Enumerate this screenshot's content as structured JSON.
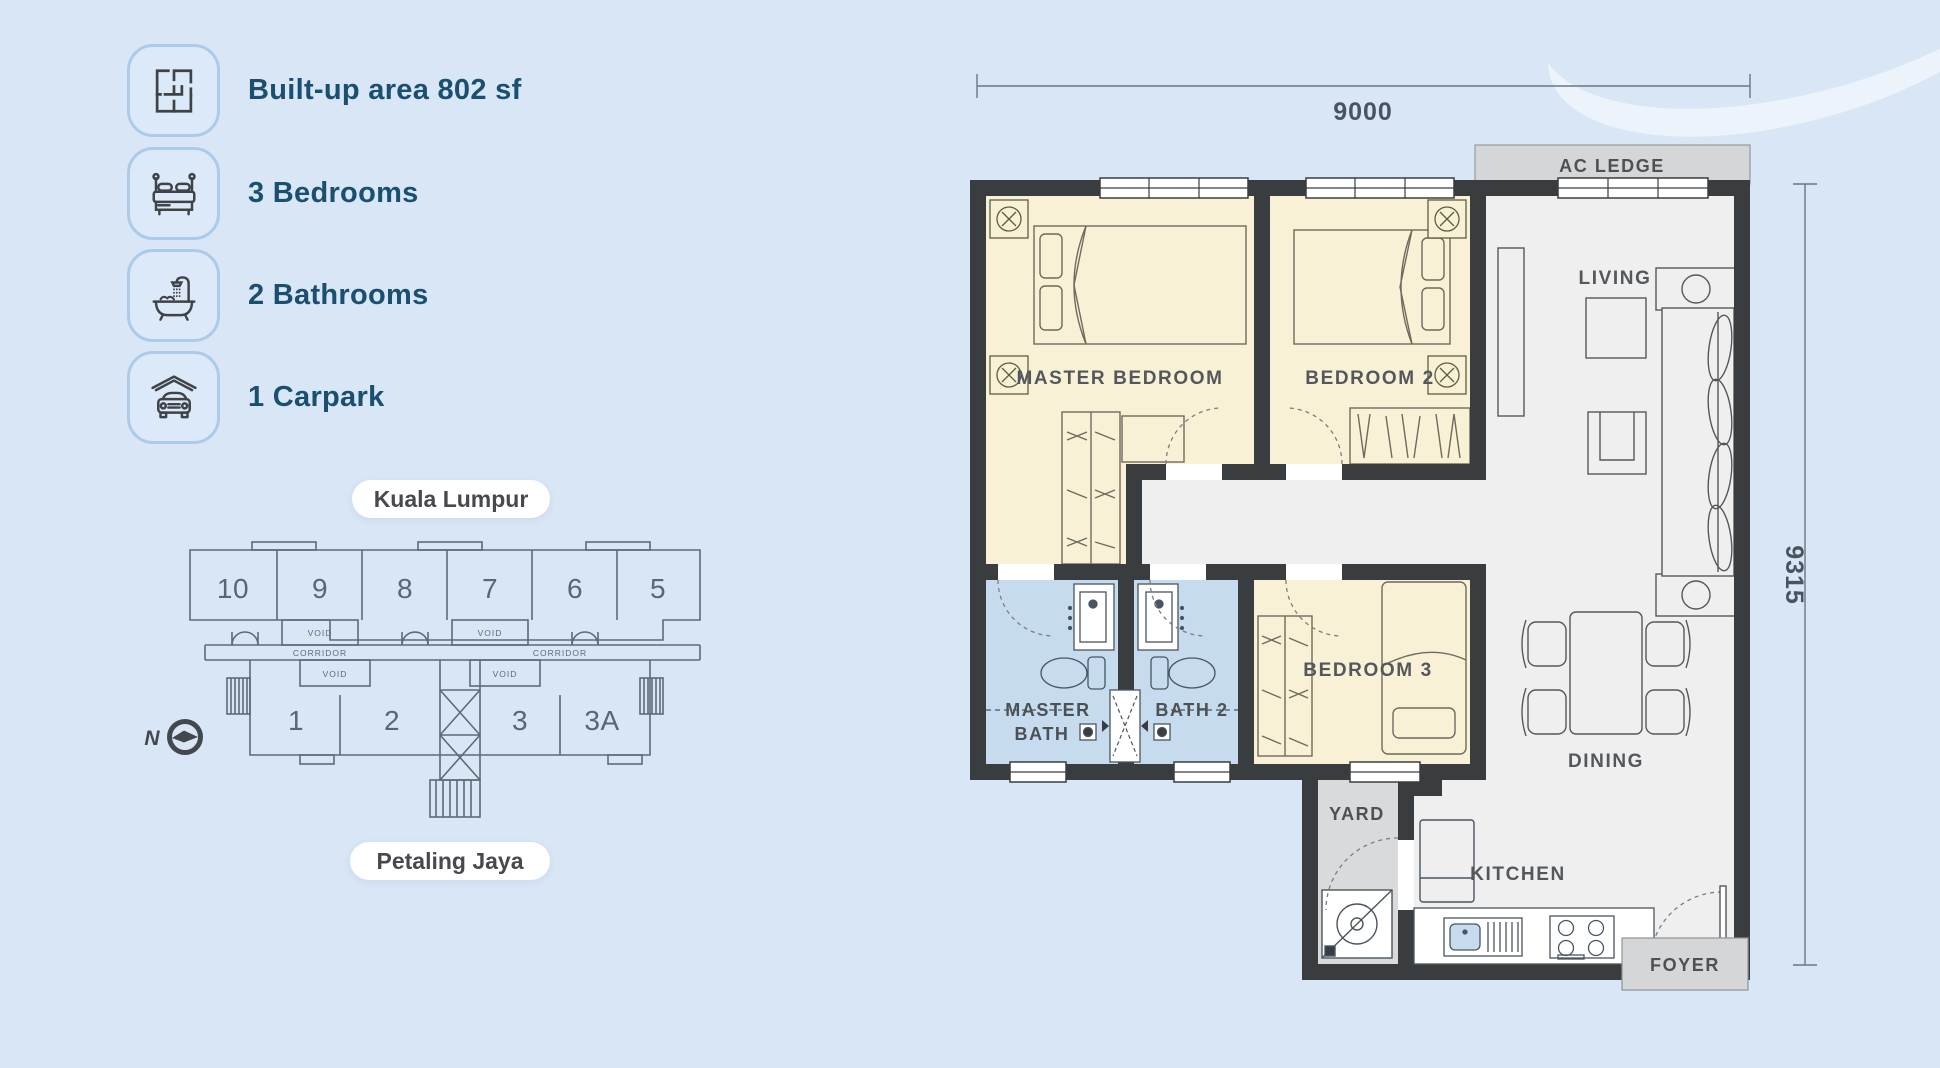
{
  "colors": {
    "background": "#d8e6f6",
    "card_border": "#abcbe9",
    "heading_text": "#1a4f70",
    "pill_bg": "#ffffff",
    "pill_text": "#46494d",
    "wall": "#3a3d40",
    "room_cream": "#f8f1d6",
    "room_bath_blue": "#c6dcee",
    "floor_gray": "#efeff0",
    "service_gray": "#d5d6d7",
    "keyplan_stroke": "#5d6b78"
  },
  "features": [
    {
      "icon": "floorplan-icon",
      "label": "Built-up area 802 sf"
    },
    {
      "icon": "bed-icon",
      "label": "3 Bedrooms"
    },
    {
      "icon": "bathtub-icon",
      "label": "2 Bathrooms"
    },
    {
      "icon": "carpark-icon",
      "label": "1 Carpark"
    }
  ],
  "locations": {
    "top_label": "Kuala Lumpur",
    "bottom_label": "Petaling Jaya"
  },
  "keyplan": {
    "units_top": [
      "10",
      "9",
      "8",
      "7",
      "6",
      "5"
    ],
    "units_bottom": [
      "1",
      "2",
      "3",
      "3A"
    ],
    "void_label": "VOID",
    "corridor_label": "CORRIDOR",
    "north_label": "N"
  },
  "floorplan": {
    "dimensions": {
      "width_mm": "9000",
      "height_mm": "9315"
    },
    "rooms": {
      "master_bedroom": "MASTER BEDROOM",
      "bedroom2": "BEDROOM 2",
      "bedroom3": "BEDROOM 3",
      "living": "LIVING",
      "dining": "DINING",
      "kitchen": "KITCHEN",
      "yard": "YARD",
      "foyer": "FOYER",
      "master_bath_line1": "MASTER",
      "master_bath_line2": "BATH",
      "bath2": "BATH 2",
      "ac_ledge": "AC LEDGE"
    }
  }
}
